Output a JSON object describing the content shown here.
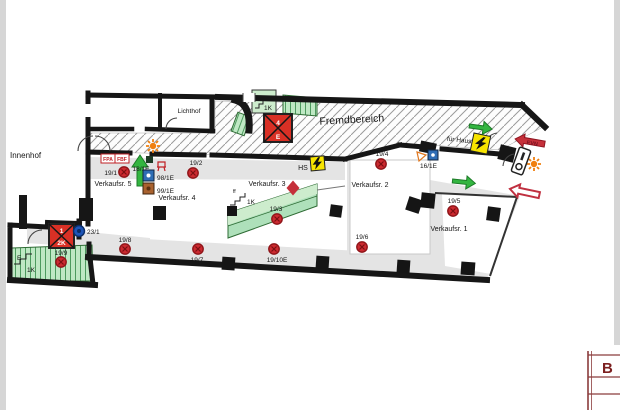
{
  "areas": {
    "innenhof": "Innenhof",
    "lichthof": "Lichthof",
    "fremdbereich": "Fremdbereich"
  },
  "rooms": [
    {
      "label": "Verkaufsr. 1"
    },
    {
      "label": "Verkaufsr. 2"
    },
    {
      "label": "Verkaufsr. 3"
    },
    {
      "label": "Verkaufsr. 4"
    },
    {
      "label": "Verkaufsr. 5"
    }
  ],
  "markers": {
    "red": [
      {
        "label": "19/1"
      },
      {
        "label": "19/2"
      },
      {
        "label": "19/3"
      },
      {
        "label": "19/4"
      },
      {
        "label": "19/5"
      },
      {
        "label": "19/6"
      },
      {
        "label": "19/7"
      },
      {
        "label": "19/8"
      },
      {
        "label": "19/9"
      },
      {
        "label": "19/10E"
      }
    ],
    "blue": {
      "label": "23/1"
    }
  },
  "equipment": {
    "hs": "HS",
    "fuer_haus": "für Haus",
    "evn": "EVN",
    "fpa": "FPA",
    "fbf": "FBF",
    "hydrant": "18/1E",
    "box_blue": "98/1E",
    "box_brown": "99/1E",
    "box_blue2": "16/1E"
  },
  "lifts": [
    {
      "top": "4",
      "bottom": "E"
    },
    {
      "top": "1",
      "bottom": "2K"
    }
  ],
  "stairs": {
    "k_top": "1K",
    "ff": "ff",
    "k_mid": "1K",
    "e": "E",
    "k_bottom": "1K"
  },
  "title_block": {
    "letter": "B"
  },
  "colors": {
    "wall": "#161616",
    "marker_red": "#cc2a30",
    "marker_blue": "#1d55b8",
    "stairs_green": "#bfe8c4",
    "arrow_green": "#33b540",
    "arrow_red": "#c5303a",
    "hazard_yellow": "#f7e400",
    "lift_red": "#d93025",
    "sun_orange": "#f08010",
    "icon_blue": "#2f6db5",
    "icon_brown": "#a9622f",
    "corridor_gray": "#e4e4e4",
    "title_red": "#7c2020"
  }
}
